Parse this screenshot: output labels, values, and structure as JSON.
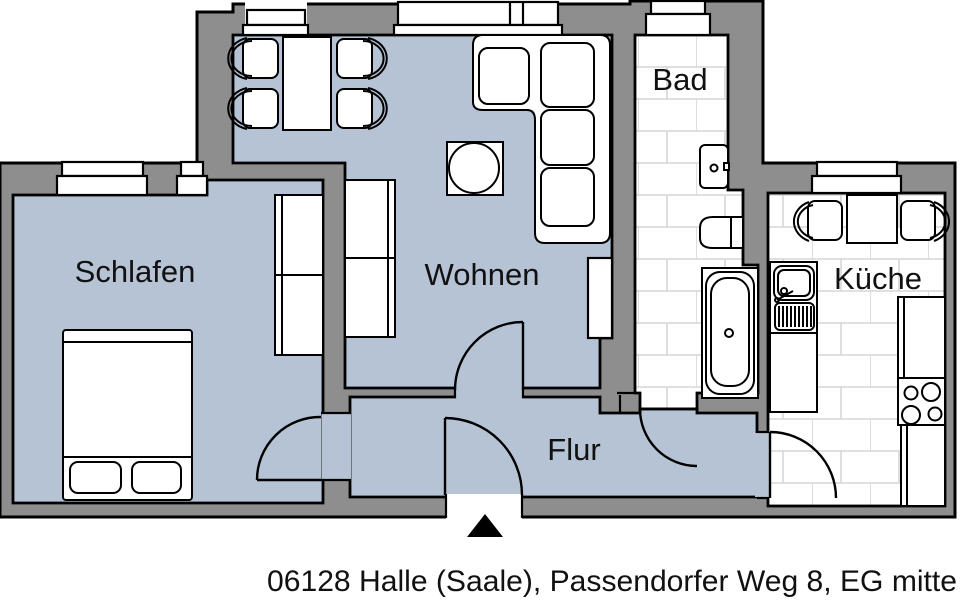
{
  "plan": {
    "caption": "06128 Halle (Saale), Passendorfer Weg 8, EG mitte",
    "rooms": {
      "schlafen": {
        "label": "Schlafen"
      },
      "wohnen": {
        "label": "Wohnen"
      },
      "bad": {
        "label": "Bad"
      },
      "kueche": {
        "label": "Küche"
      },
      "flur": {
        "label": "Flur"
      }
    },
    "colors": {
      "wall": "#8e8e8e",
      "floor": "#b5c3d4",
      "tile_background": "#ffffff",
      "tile_line": "#d6d6d6",
      "outline": "#000000",
      "text": "#111111",
      "background": "#ffffff",
      "furniture": "#ffffff"
    },
    "fixtures": {
      "schlafen": [
        "double-bed",
        "wardrobe",
        "window",
        "door-swing"
      ],
      "wohnen": [
        "dining-table",
        "dining-chairs",
        "corner-sofa",
        "coffee-table",
        "wardrobe",
        "radiator-niche",
        "windows",
        "door-swing"
      ],
      "bad": [
        "washbasin",
        "toilet",
        "bathtub",
        "window",
        "door-swing"
      ],
      "kueche": [
        "kitchen-table",
        "kitchen-chairs",
        "sink-unit",
        "counters",
        "stove-4-burners",
        "window",
        "door-swing"
      ],
      "flur": [
        "entrance-door",
        "entrance-arrow"
      ]
    }
  }
}
